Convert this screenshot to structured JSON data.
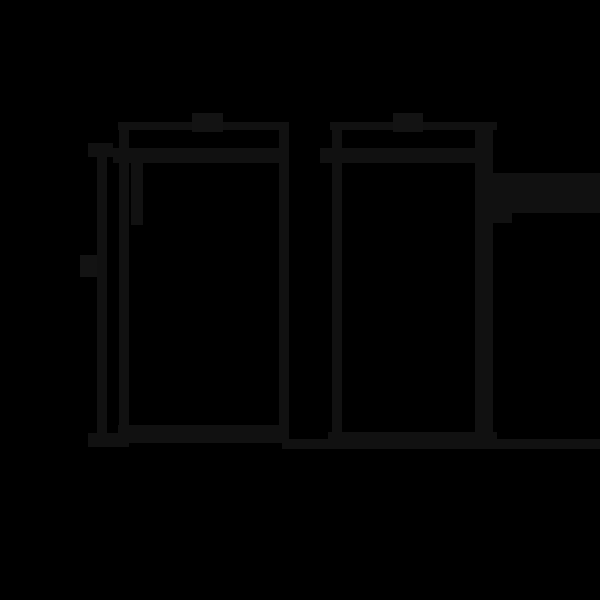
{
  "canvas": {
    "width": 600,
    "height": 600,
    "background_color": "#000000"
  },
  "drawing": {
    "description_colors": {
      "stroke": "#111111",
      "label_blob": "#131313"
    },
    "shapes": [
      {
        "name": "left-panel-width-dimension-line",
        "role": "line",
        "x": 118,
        "y": 122,
        "w": 170,
        "h": 8
      },
      {
        "name": "left-panel-width-label-blob",
        "role": "label",
        "x": 192,
        "y": 113,
        "w": 31,
        "h": 19
      },
      {
        "name": "left-panel-left-edge",
        "role": "line",
        "x": 119,
        "y": 122,
        "w": 10,
        "h": 325
      },
      {
        "name": "left-panel-right-edge",
        "role": "line",
        "x": 279,
        "y": 122,
        "w": 10,
        "h": 321
      },
      {
        "name": "left-panel-top-edge",
        "role": "line",
        "x": 113,
        "y": 148,
        "w": 176,
        "h": 15
      },
      {
        "name": "left-panel-bottom-edge",
        "role": "line",
        "x": 118,
        "y": 425,
        "w": 171,
        "h": 18
      },
      {
        "name": "left-panel-inner-hinge-line",
        "role": "line",
        "x": 131,
        "y": 163,
        "w": 12,
        "h": 62
      },
      {
        "name": "height-dimension-line",
        "role": "line",
        "x": 97,
        "y": 143,
        "w": 10,
        "h": 304
      },
      {
        "name": "height-dimension-top-tick",
        "role": "line",
        "x": 88,
        "y": 143,
        "w": 25,
        "h": 14
      },
      {
        "name": "height-dimension-bottom-tick",
        "role": "line",
        "x": 88,
        "y": 433,
        "w": 32,
        "h": 14
      },
      {
        "name": "height-dimension-label-blob",
        "role": "label",
        "x": 80,
        "y": 255,
        "w": 17,
        "h": 22
      },
      {
        "name": "right-panel-width-dimension-line",
        "role": "line",
        "x": 330,
        "y": 122,
        "w": 167,
        "h": 8
      },
      {
        "name": "right-panel-width-label-blob",
        "role": "label",
        "x": 393,
        "y": 113,
        "w": 30,
        "h": 19
      },
      {
        "name": "right-panel-left-edge",
        "role": "line",
        "x": 332,
        "y": 122,
        "w": 10,
        "h": 321
      },
      {
        "name": "right-panel-right-edge",
        "role": "line",
        "x": 475,
        "y": 122,
        "w": 18,
        "h": 325
      },
      {
        "name": "right-panel-top-edge",
        "role": "line",
        "x": 320,
        "y": 148,
        "w": 173,
        "h": 15
      },
      {
        "name": "right-panel-bottom-edge",
        "role": "line",
        "x": 328,
        "y": 432,
        "w": 169,
        "h": 15
      },
      {
        "name": "right-side-protrusion-bar",
        "role": "line",
        "x": 493,
        "y": 173,
        "w": 107,
        "h": 40
      },
      {
        "name": "right-side-protrusion-step",
        "role": "line",
        "x": 493,
        "y": 213,
        "w": 19,
        "h": 10
      },
      {
        "name": "floor-baseline",
        "role": "line",
        "x": 282,
        "y": 439,
        "w": 318,
        "h": 10
      }
    ]
  }
}
